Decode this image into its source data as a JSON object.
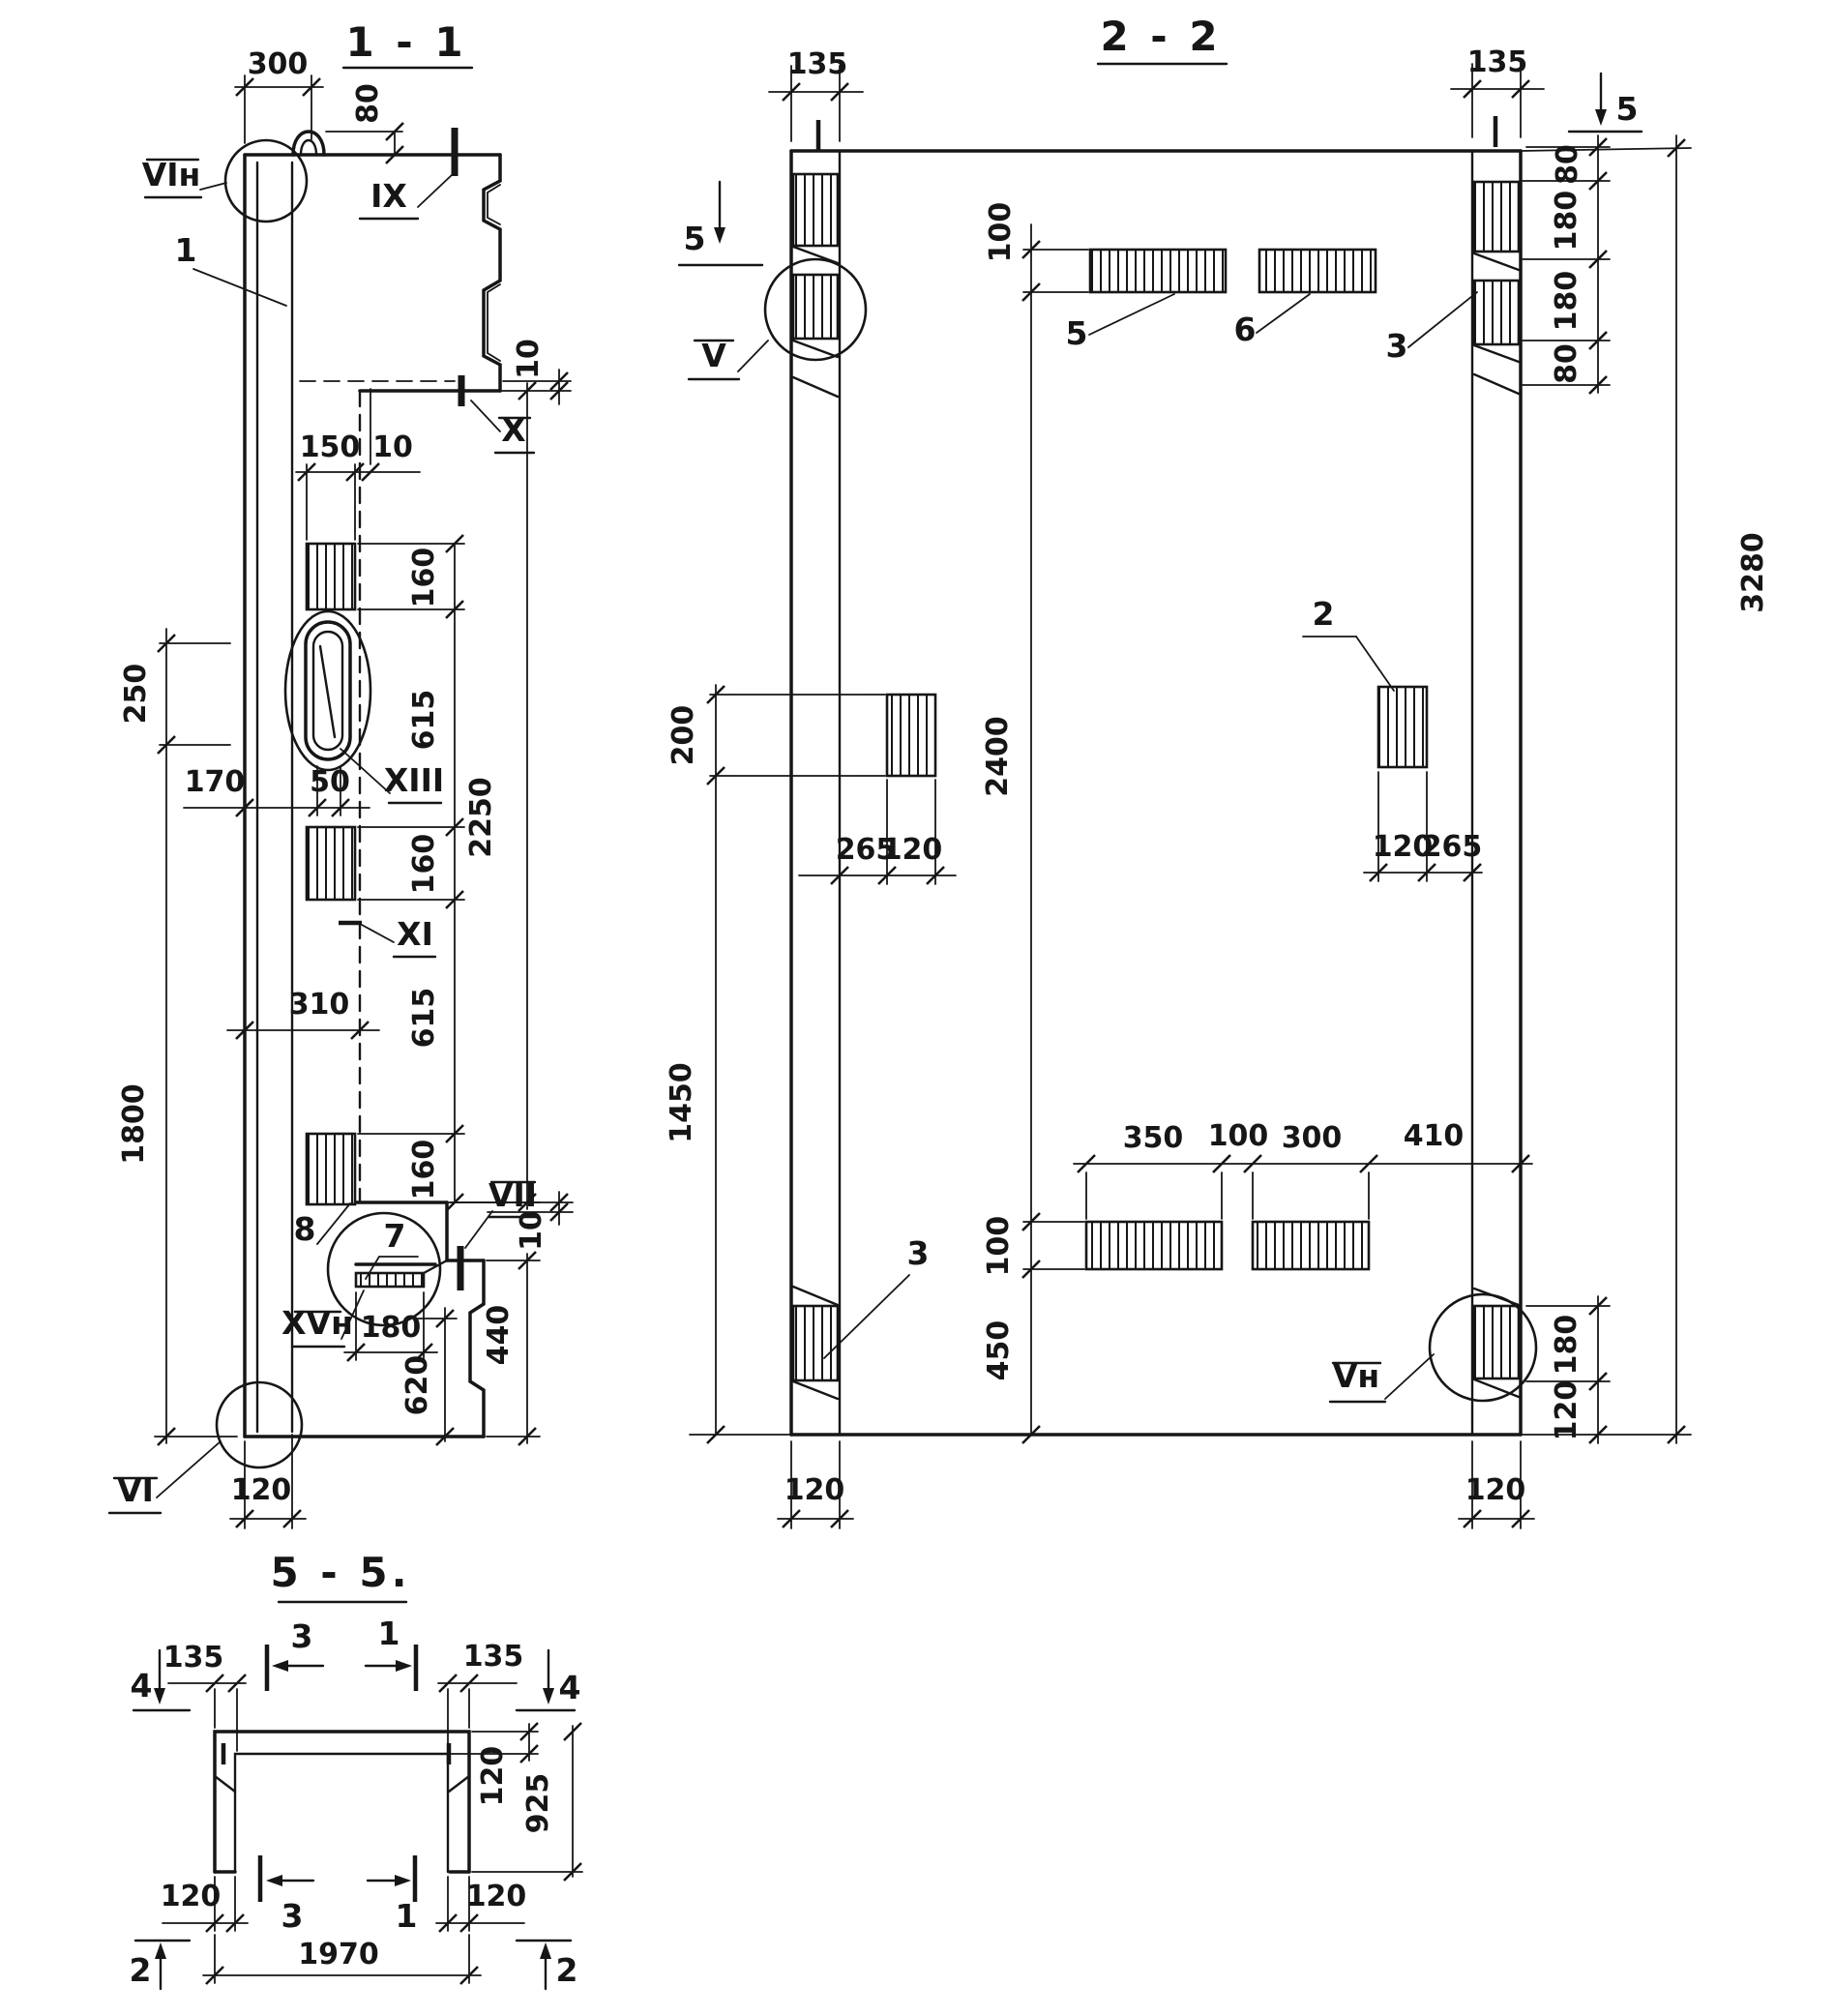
{
  "page": {
    "background": "#ffffff",
    "ink": "#161616",
    "type": "structural panel working drawing, three sections"
  },
  "s11": {
    "title": "1 - 1",
    "dims": {
      "d300": "300",
      "d80": "80",
      "d150": "150",
      "d10t": "10",
      "d160a": "160",
      "d615a": "615",
      "d160b": "160",
      "d615b": "615",
      "d160c": "160",
      "d250": "250",
      "d1800": "1800",
      "d170": "170",
      "d50": "50",
      "d310": "310",
      "d2250": "2250",
      "d10x": "10",
      "d180": "180",
      "d620": "620",
      "d440": "440",
      "d10v": "10",
      "d120": "120"
    },
    "labels": {
      "vin": "VIн",
      "ix": "IX",
      "p1": "1",
      "x": "X",
      "xiii": "XIII",
      "xi": "XI",
      "p8": "8",
      "p7": "7",
      "vii": "VII",
      "xvn": "XVн",
      "vi": "VI"
    }
  },
  "s22": {
    "title": "2 - 2",
    "markers": {
      "m5l": "5",
      "m5r": "5"
    },
    "dims": {
      "d135l": "135",
      "d135r": "135",
      "d80a": "80",
      "d180a": "180",
      "d180b": "180",
      "d80b": "80",
      "d3280": "3280",
      "d100a": "100",
      "d2400": "2400",
      "d100b": "100",
      "d450": "450",
      "d200": "200",
      "d1450": "1450",
      "d265a": "265",
      "d120a": "120",
      "d120b": "120",
      "d265b": "265",
      "d350": "350",
      "d100c": "100",
      "d300": "300",
      "d410": "410",
      "d180c": "180",
      "d120c": "120",
      "d120d": "120",
      "d120e": "120"
    },
    "labels": {
      "v": "V",
      "vn": "Vн",
      "p2": "2",
      "p3a": "3",
      "p3b": "3",
      "p5": "5",
      "p6": "6"
    }
  },
  "s55": {
    "title": "5 - 5.",
    "markers": {
      "m4l": "4",
      "m4r": "4",
      "m3t": "3",
      "m1t": "1",
      "m3b": "3",
      "m1b": "1",
      "m2l": "2",
      "m2r": "2"
    },
    "dims": {
      "d135l": "135",
      "d135r": "135",
      "d120t": "120",
      "d925": "925",
      "d120l": "120",
      "d120r": "120",
      "d1970": "1970"
    }
  }
}
